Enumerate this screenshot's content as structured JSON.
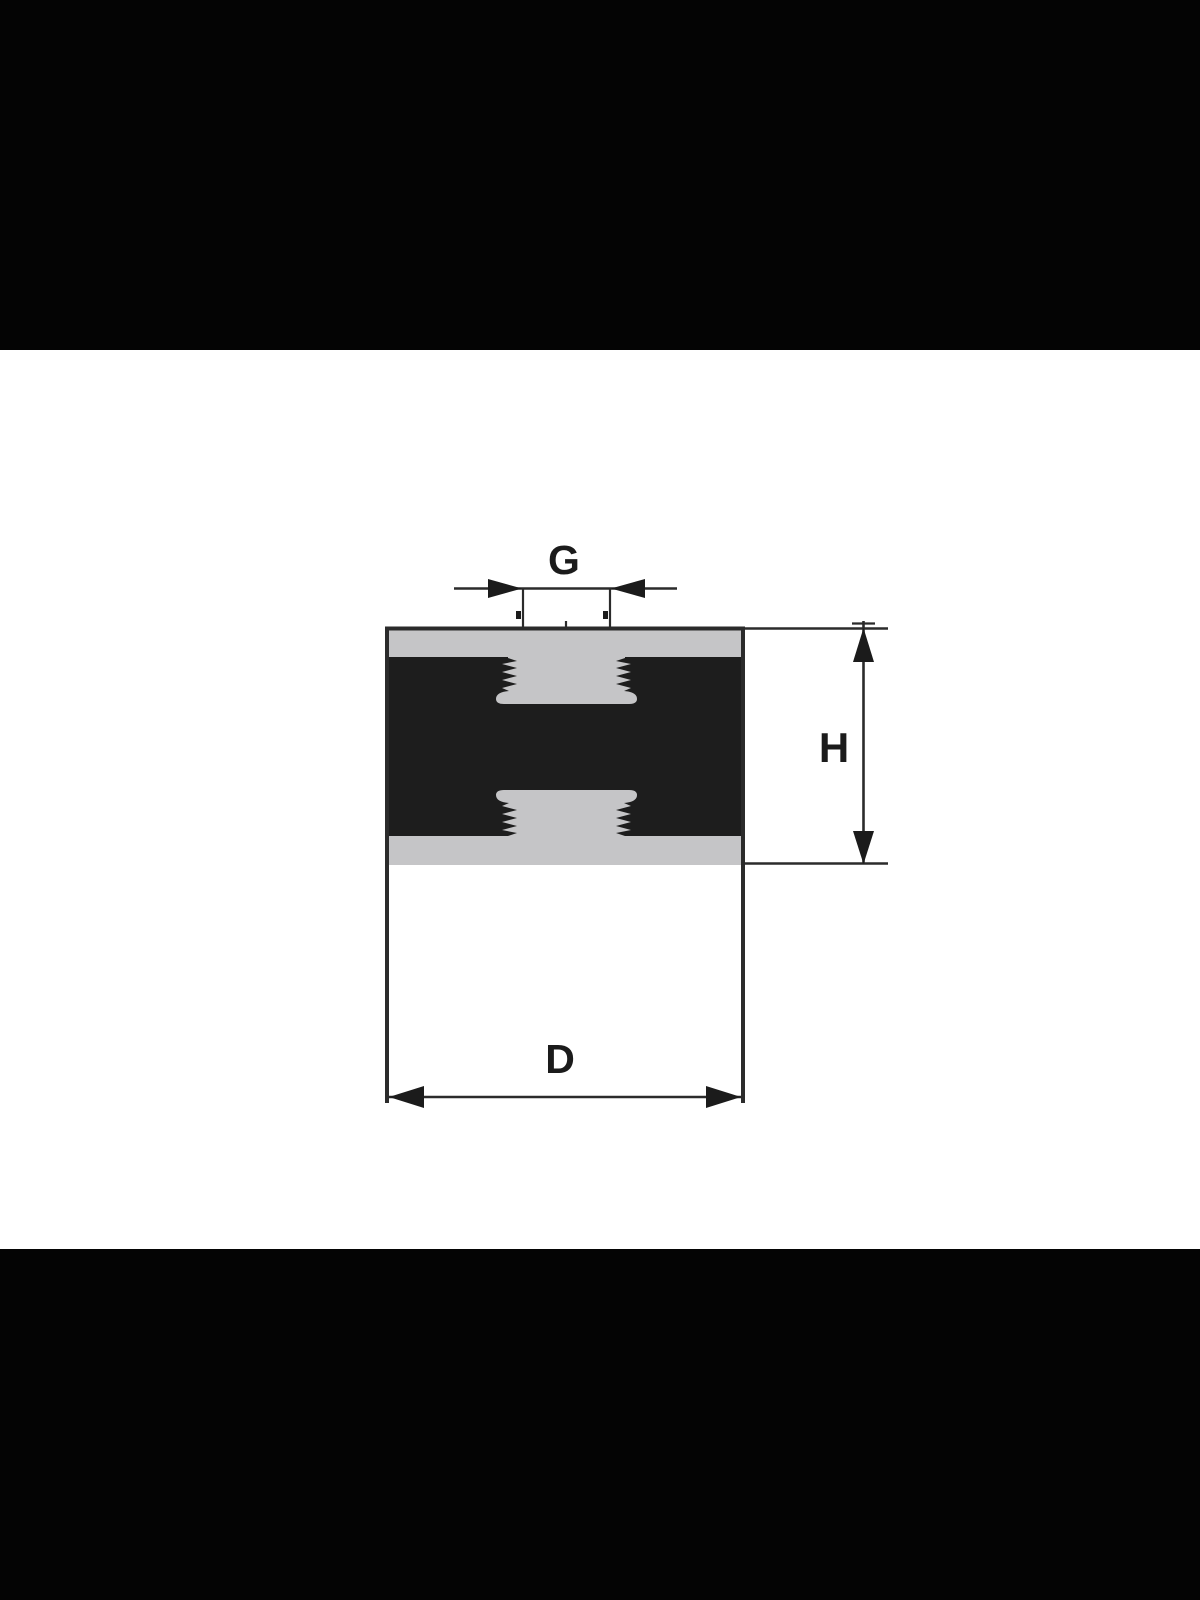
{
  "image": {
    "description": "Engineering cross-section drawing of a cylindrical rubber-metal anti-vibration mount (damper) with internal threaded holes at top and bottom, letterboxed by black bands",
    "letterbox_color": "#040404",
    "canvas_color": "#ffffff"
  },
  "drawing": {
    "labels": {
      "thread_diameter": "G",
      "height": "H",
      "outer_diameter": "D"
    },
    "colors": {
      "ink": "#2b2b2b",
      "arrow_fill": "#1b1b1b",
      "rubber_body": "#1d1d1d",
      "metal_plate": "#c5c5c7"
    }
  }
}
